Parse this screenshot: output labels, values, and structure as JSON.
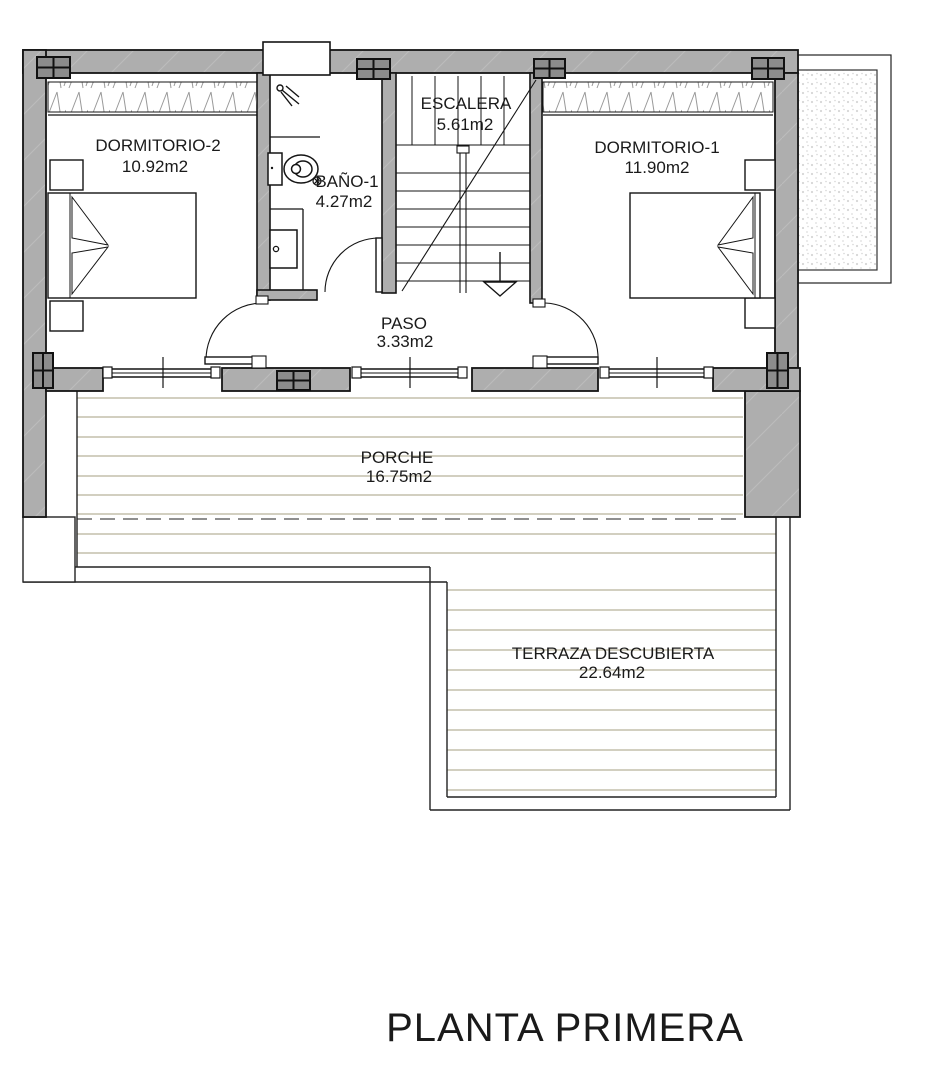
{
  "title": "PLANTA PRIMERA",
  "rooms": [
    {
      "name": "DORMITORIO-2",
      "area": "10.92m2"
    },
    {
      "name": "BAÑO-1",
      "area": "4.27m2"
    },
    {
      "name": "ESCALERA",
      "area": "5.61m2"
    },
    {
      "name": "DORMITORIO-1",
      "area": "11.90m2"
    },
    {
      "name": "PASO",
      "area": "3.33m2"
    },
    {
      "name": "PORCHE",
      "area": "16.75m2"
    },
    {
      "name": "TERRAZA DESCUBIERTA",
      "area": "22.64m2"
    }
  ],
  "colors": {
    "background": "#ffffff",
    "wall_fill": "#aeaeae",
    "pillar_fill": "#8c8c8c",
    "outline": "#141414",
    "deck_line": "#b8b29a",
    "dashed_overhang": "#8f8f8f",
    "gravel_dot": "#d6d6d6",
    "text": "#1a1a1a"
  }
}
